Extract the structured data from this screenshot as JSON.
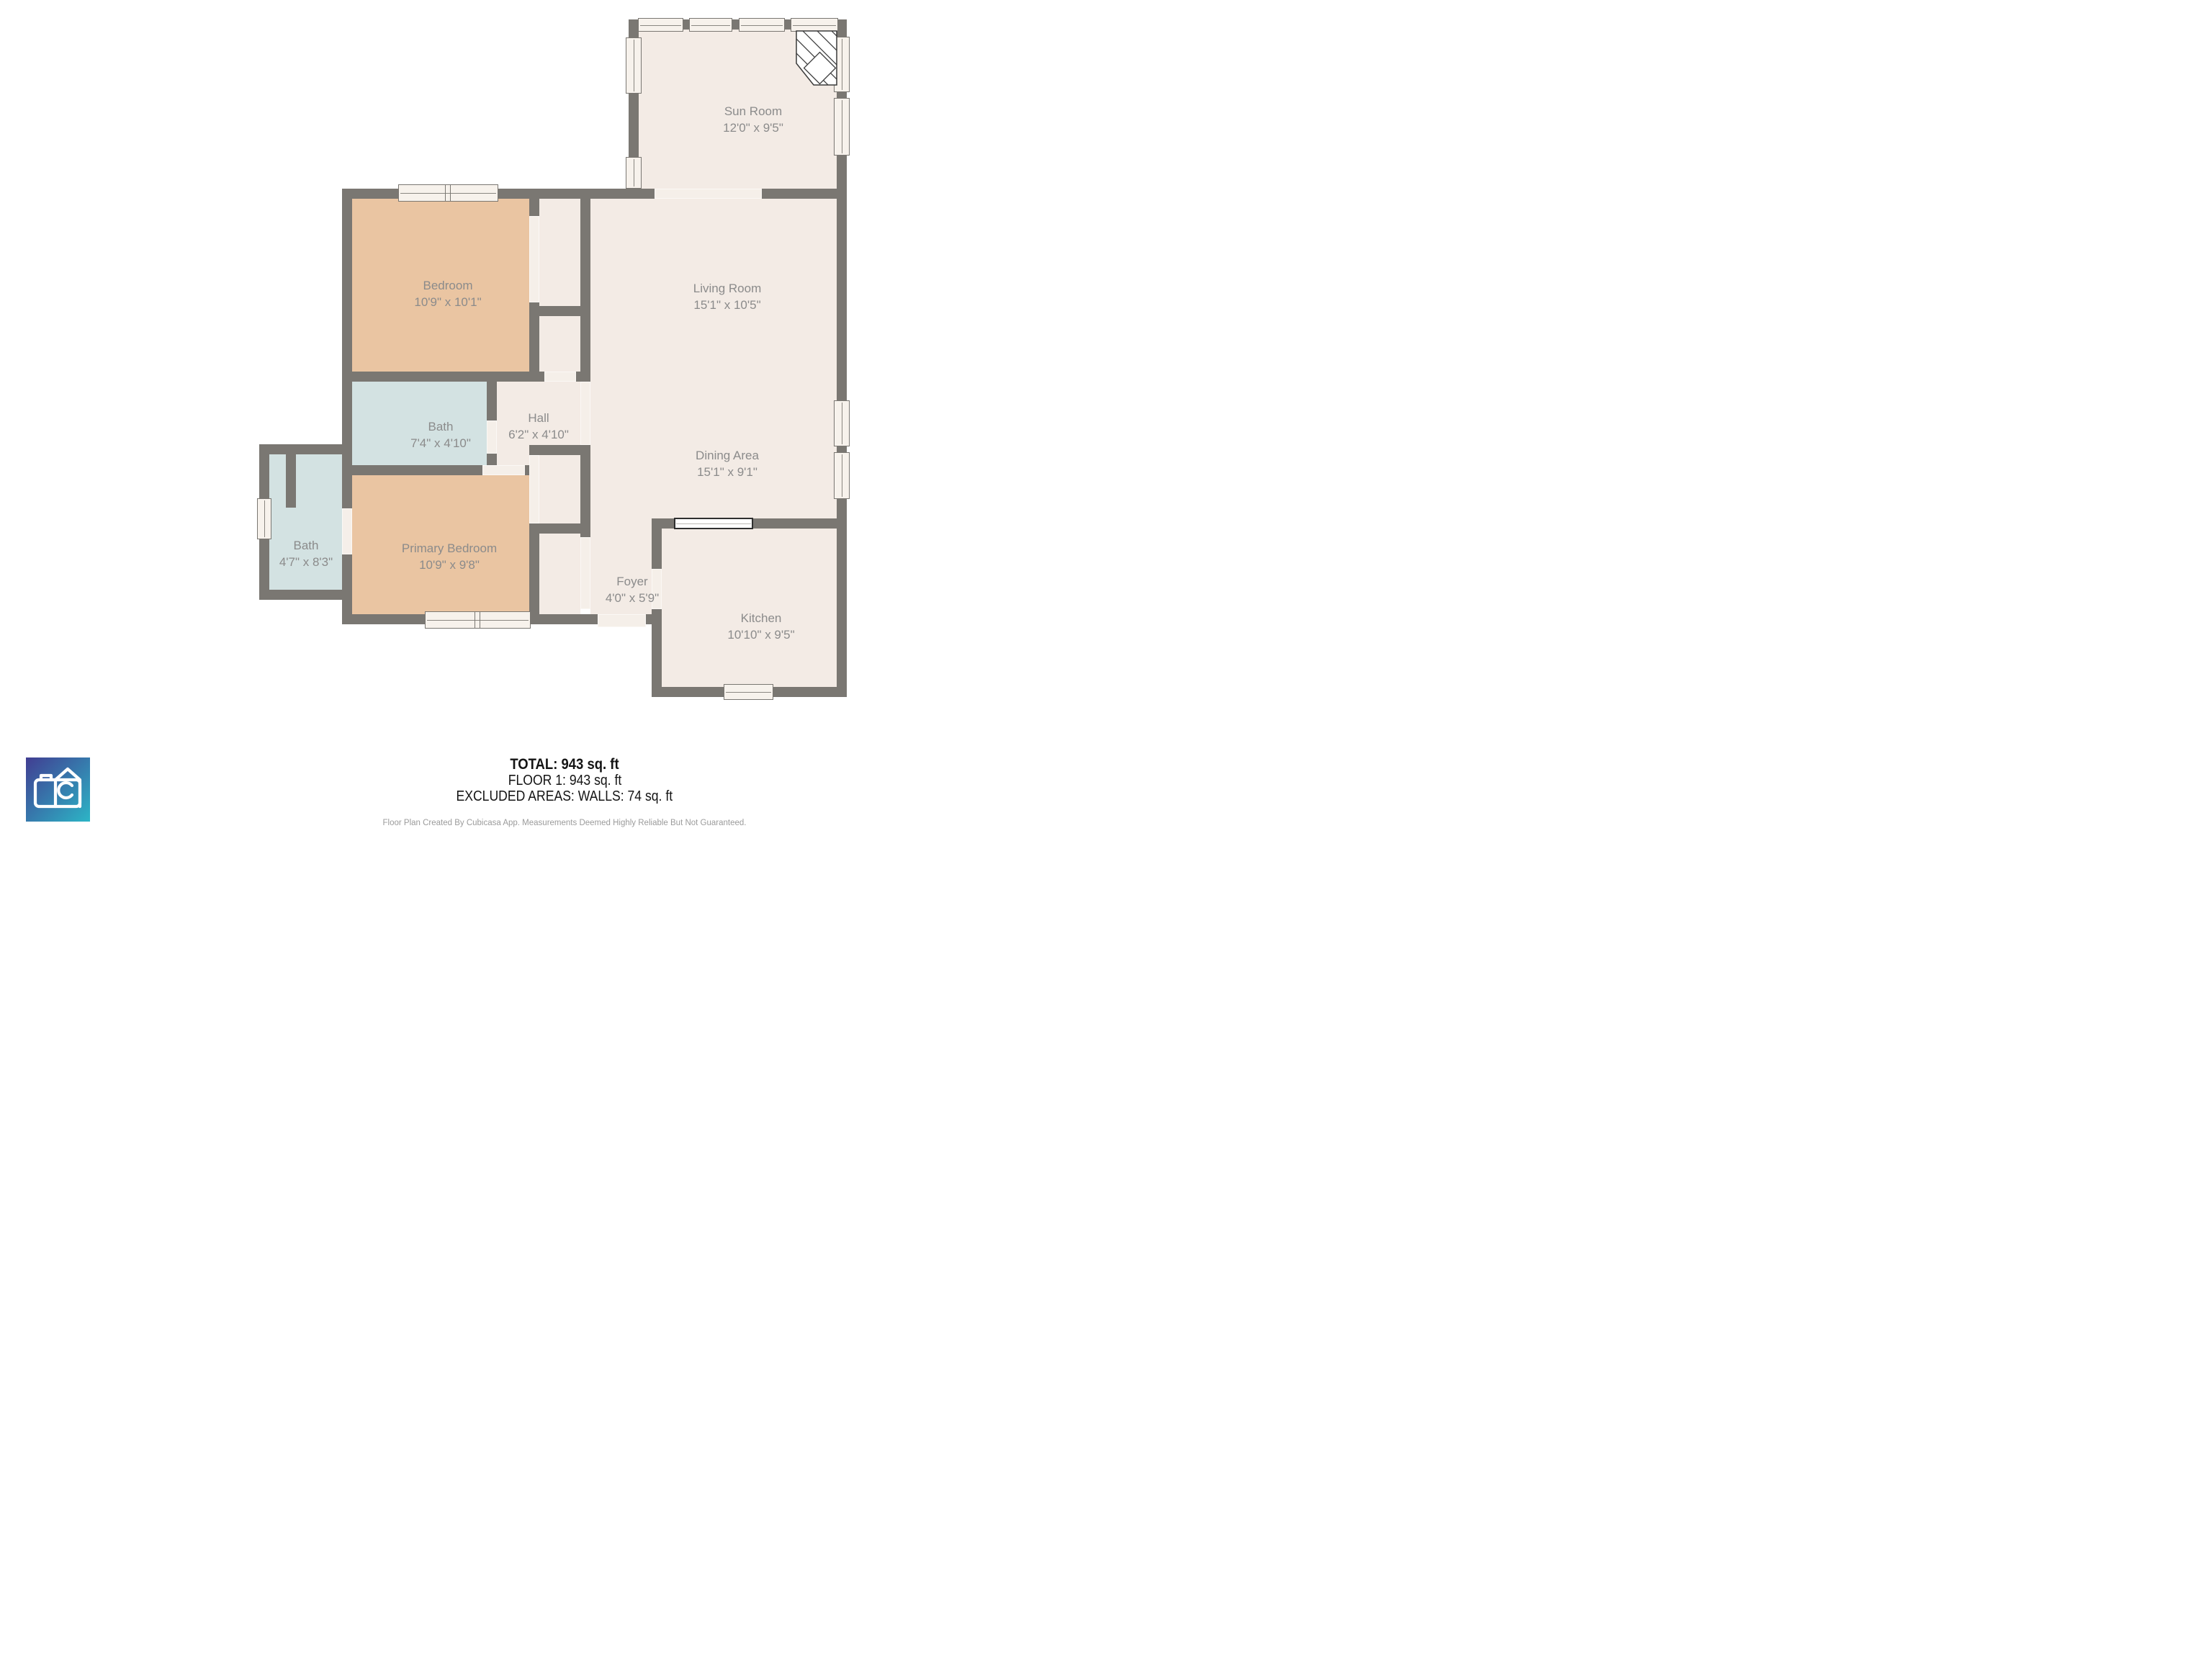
{
  "plan": {
    "rooms": [
      {
        "id": "sun-room",
        "name": "Sun Room",
        "dims": "12'0\" x 9'5\"",
        "fill": "#f3ebe5"
      },
      {
        "id": "bedroom",
        "name": "Bedroom",
        "dims": "10'9\" x 10'1\"",
        "fill": "#eac5a2"
      },
      {
        "id": "living-room",
        "name": "Living Room",
        "dims": "15'1\" x 10'5\"",
        "fill": "#f3ebe5"
      },
      {
        "id": "bath",
        "name": "Bath",
        "dims": "7'4\" x 4'10\"",
        "fill": "#d3e2e2"
      },
      {
        "id": "hall",
        "name": "Hall",
        "dims": "6'2\" x 4'10\"",
        "fill": "#f3ebe5"
      },
      {
        "id": "dining-area",
        "name": "Dining Area",
        "dims": "15'1\" x 9'1\"",
        "fill": "#f3ebe5"
      },
      {
        "id": "bath-2",
        "name": "Bath",
        "dims": "4'7\" x 8'3\"",
        "fill": "#d3e2e2"
      },
      {
        "id": "primary-bedroom",
        "name": "Primary Bedroom",
        "dims": "10'9\" x 9'8\"",
        "fill": "#eac5a2"
      },
      {
        "id": "foyer",
        "name": "Foyer",
        "dims": "4'0\" x 5'9\"",
        "fill": "#f3ebe5"
      },
      {
        "id": "kitchen",
        "name": "Kitchen",
        "dims": "10'10\" x 9'5\"",
        "fill": "#f3ebe5"
      }
    ]
  },
  "footer": {
    "total": "TOTAL: 943 sq. ft",
    "floor": "FLOOR 1: 943 sq. ft",
    "excluded": "EXCLUDED AREAS: WALLS: 74 sq. ft",
    "disclaimer": "Floor Plan Created By Cubicasa App. Measurements Deemed Highly Reliable But Not Guaranteed."
  },
  "colors": {
    "wall": "#7a7772",
    "floor": "#f3ebe5",
    "bedroom_tan": "#eac5a2",
    "bath_blue": "#d3e2e2",
    "opening": "#f5efe9",
    "window_fill": "#f7f2ec",
    "counter_outline": "#2f2f2f",
    "room_label": "#8b8b8b",
    "stats_text": "#141414",
    "disclaimer_text": "#9b9b9b",
    "logo_gradient_start": "#413d92",
    "logo_gradient_end": "#2cb5c6"
  }
}
